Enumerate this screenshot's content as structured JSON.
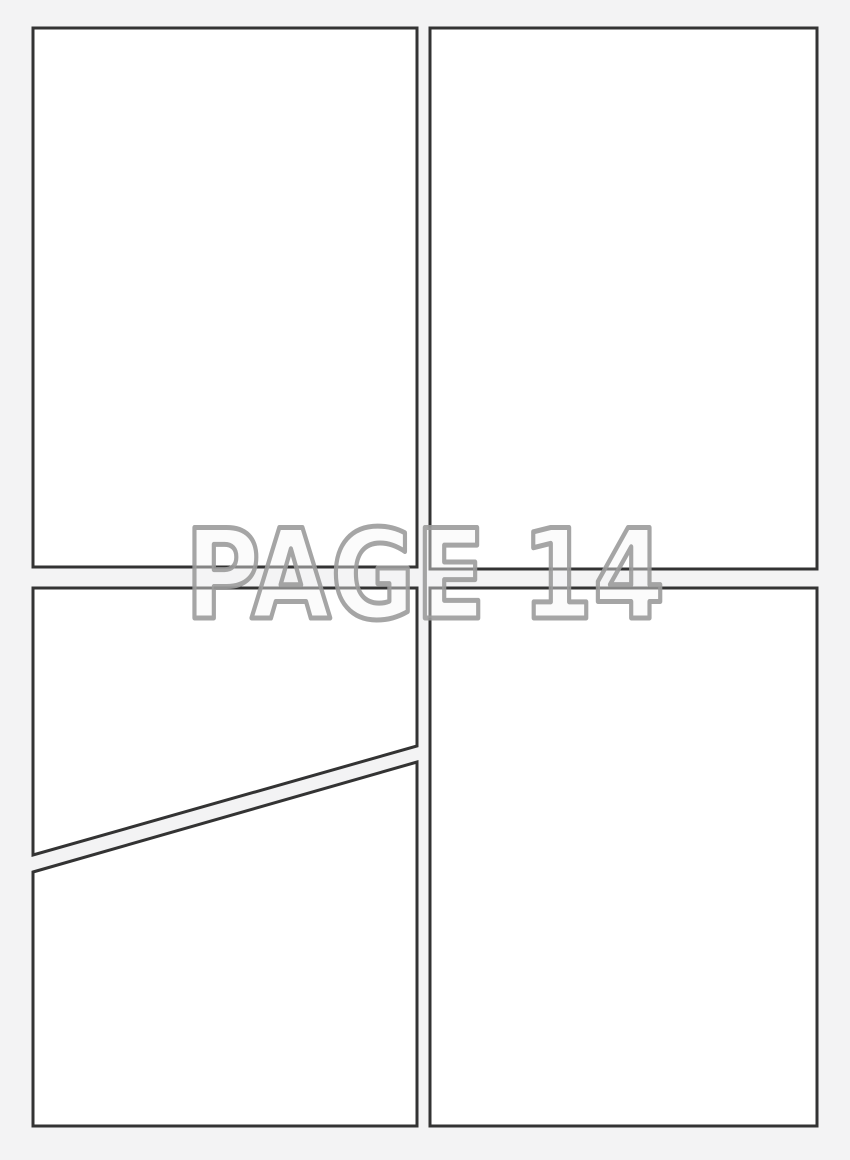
{
  "page": {
    "label": "PAGE 14"
  },
  "panels": [
    {
      "id": "panel-1",
      "position": "top-left",
      "shape": "rectangle"
    },
    {
      "id": "panel-2",
      "position": "top-right",
      "shape": "rectangle"
    },
    {
      "id": "panel-3",
      "position": "middle-left",
      "shape": "quad-diagonal-bottom-edge"
    },
    {
      "id": "panel-4",
      "position": "bottom-left",
      "shape": "quad-diagonal-top-edge"
    },
    {
      "id": "panel-5",
      "position": "bottom-right",
      "shape": "rectangle"
    }
  ],
  "colors": {
    "background": "#f3f3f4",
    "panel_fill": "#ffffff",
    "panel_border": "#333333",
    "label_fill": "#f5f5f6",
    "label_outline": "#9b9b9b"
  }
}
